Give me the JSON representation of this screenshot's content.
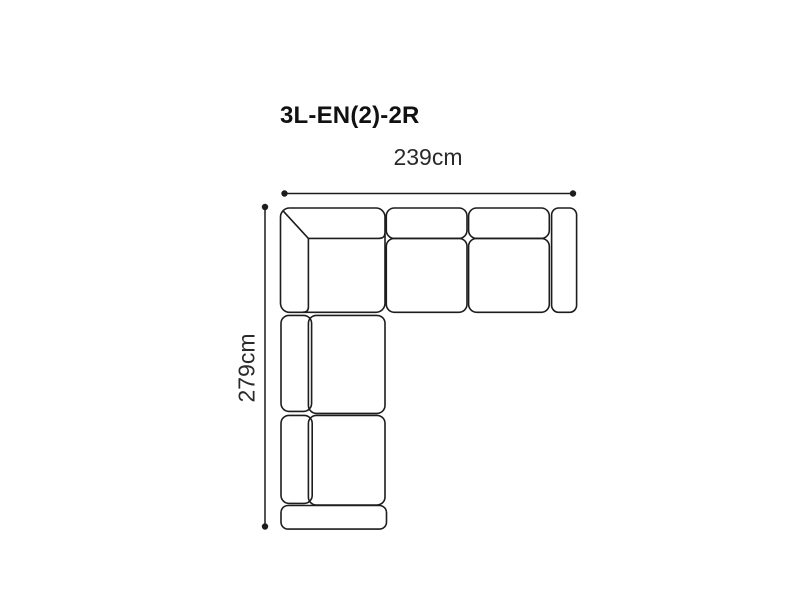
{
  "diagram": {
    "title": "3L-EN(2)-2R",
    "width_label": "239cm",
    "height_label": "279cm",
    "width_cm": 239,
    "height_cm": 279,
    "subject": "corner-sofa-top-view",
    "colors": {
      "background": "#ffffff",
      "line": "#1d1d1d",
      "text": "#2a2a2a",
      "title_text": "#111111"
    }
  }
}
